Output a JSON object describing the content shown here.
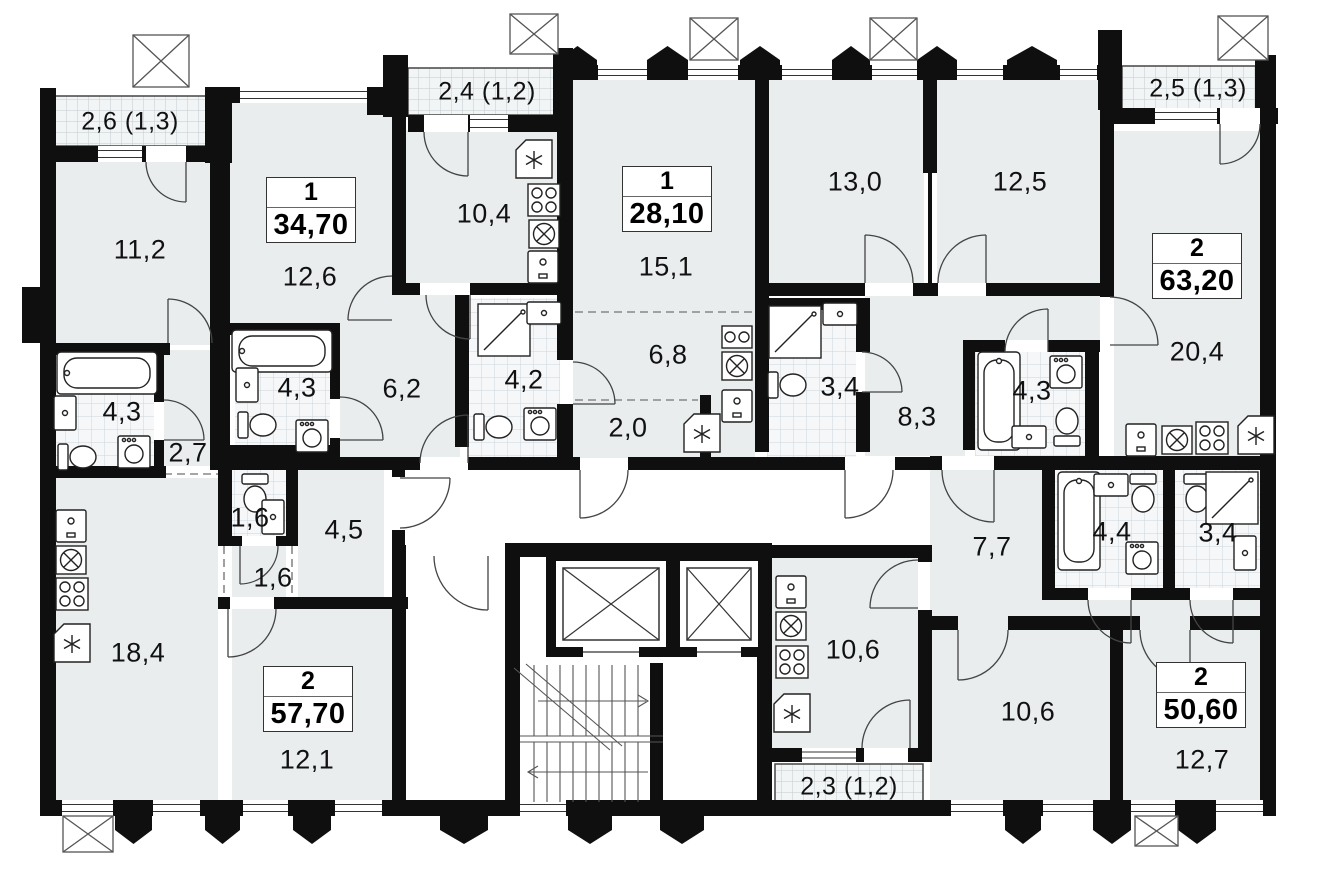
{
  "floor_plan": {
    "kind": "residential floor plan",
    "apartments": [
      {
        "rooms": "1",
        "total_area": "34,70"
      },
      {
        "rooms": "1",
        "total_area": "28,10"
      },
      {
        "rooms": "2",
        "total_area": "63,20"
      },
      {
        "rooms": "2",
        "total_area": "57,70"
      },
      {
        "rooms": "2",
        "total_area": "50,60"
      }
    ],
    "balconies": [
      {
        "area": "2,6 (1,3)"
      },
      {
        "area": "2,4 (1,2)"
      },
      {
        "area": "2,5 (1,3)"
      },
      {
        "area": "2,3 (1,2)"
      }
    ],
    "rooms": [
      "11,2",
      "12,6",
      "10,4",
      "15,1",
      "13,0",
      "12,5",
      "20,4",
      "4,3",
      "2,7",
      "4,3",
      "6,2",
      "4,2",
      "2,0",
      "6,8",
      "3,4",
      "8,3",
      "4,3",
      "7,7",
      "4,4",
      "3,4",
      "1,6",
      "1,6",
      "4,5",
      "18,4",
      "12,1",
      "10,6",
      "10,6",
      "12,7"
    ],
    "icons": {
      "bathtub": "bathtub-icon",
      "toilet": "toilet-icon",
      "sink": "sink-icon",
      "shower": "shower-icon",
      "washer": "washing-machine-icon",
      "stove": "stove-icon",
      "hob": "hob-sink-icon",
      "fridge": "fridge-icon",
      "elevator": "elevator-icon",
      "stairs": "stairs-icon"
    },
    "colors": {
      "wall": "#0f0f0f",
      "room_fill": "#e9edee",
      "tile_fill": "#f5f7f8"
    }
  }
}
